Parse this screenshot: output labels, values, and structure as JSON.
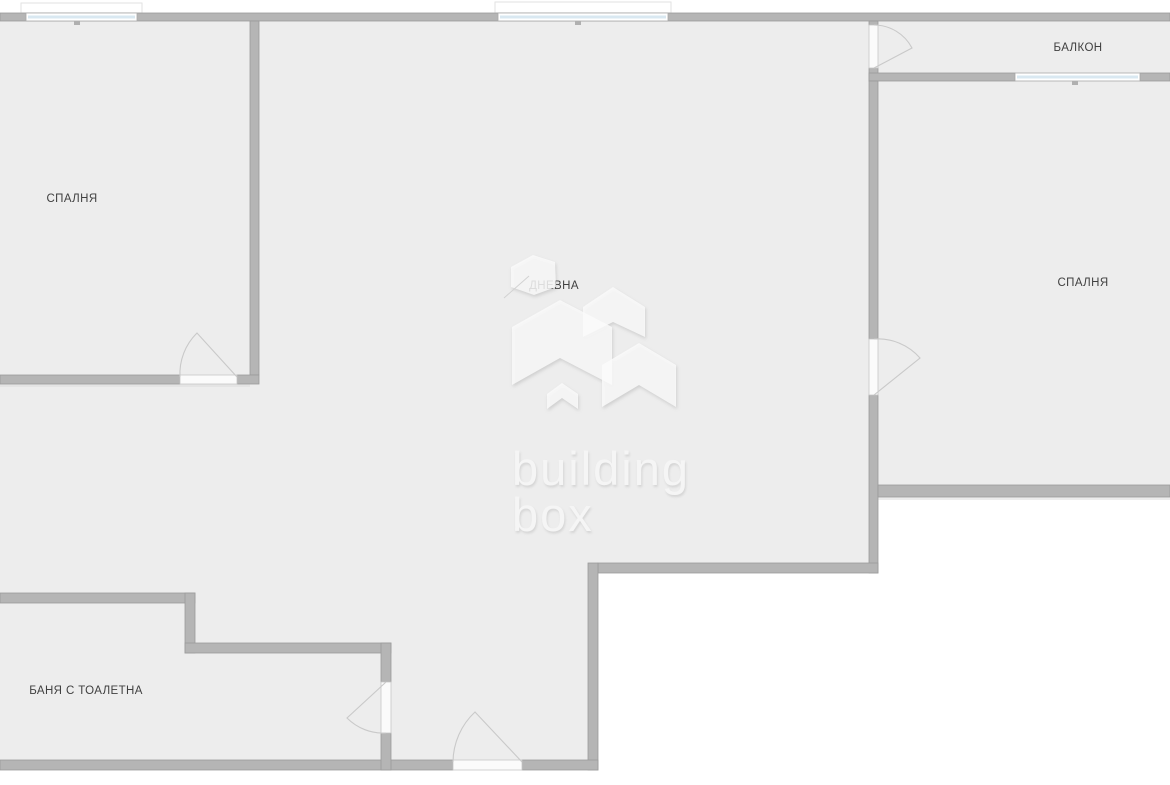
{
  "plan": {
    "type": "apartment-floor-plan",
    "rooms": [
      {
        "id": "bedroom-left",
        "label": "СПАЛНЯ"
      },
      {
        "id": "living-room",
        "label": "ДНЕВНА"
      },
      {
        "id": "balcony",
        "label": "БАЛКОН"
      },
      {
        "id": "bedroom-right",
        "label": "СПАЛНЯ"
      },
      {
        "id": "bathroom",
        "label": "БАНЯ С ТОАЛЕТНА"
      }
    ],
    "watermark": {
      "line1": "building",
      "line2": "box"
    },
    "colors": {
      "outside": "#ffffff",
      "floor": "#ededed",
      "wall": "#b5b5b5",
      "wall_edge": "#9b9b9b",
      "window_glass": "#d9e8f1",
      "door_leaf": "#fbfbfb",
      "door_arc": "#c9c9c9",
      "label_text": "#404040",
      "watermark_shape": "#fbfbfb",
      "watermark_text": "#f5f5f5"
    }
  }
}
